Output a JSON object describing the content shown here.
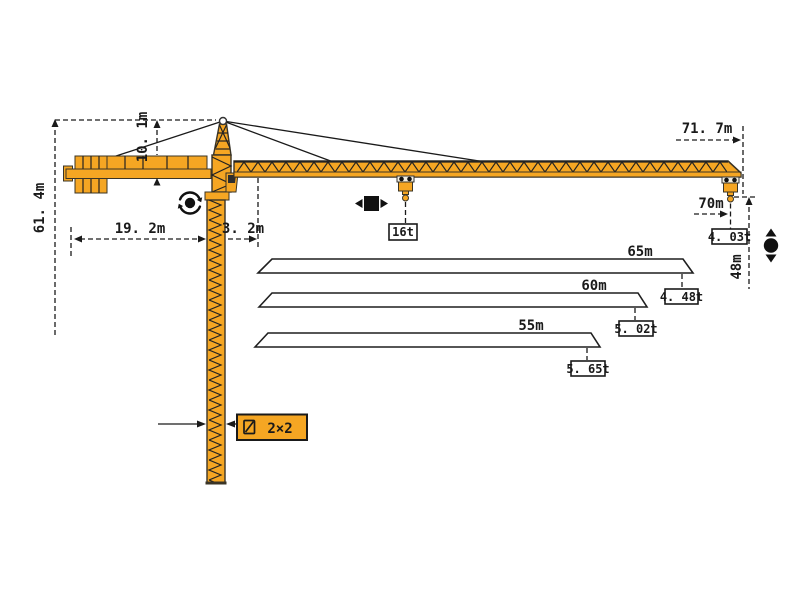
{
  "colors": {
    "crane_orange": "#F5A623",
    "outline_dark": "#3a3426",
    "line_black": "#1a1a1a",
    "background": "#ffffff"
  },
  "crane": {
    "dimensions": {
      "total_height": "61. 4m",
      "head_height": "10. 1m",
      "counter_jib_length": "19. 2m",
      "jib_root_offset": "3. 2m",
      "max_radius": "71. 7m",
      "tip_radius": "70m",
      "under_hook_height": "48m",
      "mast_section": "2×2"
    },
    "loads": {
      "max_load": "16t",
      "tip_load": "4. 03t"
    }
  },
  "jib_variants": [
    {
      "length": "65m",
      "tip_load": "4. 48t"
    },
    {
      "length": "60m",
      "tip_load": "5. 02t"
    },
    {
      "length": "55m",
      "tip_load": "5. 65t"
    }
  ],
  "icons": {
    "slewing": "slewing-rotation-icon",
    "trolley": "trolley-travel-icon",
    "hoist": "hook-hoist-icon",
    "section": "mast-section-icon"
  }
}
